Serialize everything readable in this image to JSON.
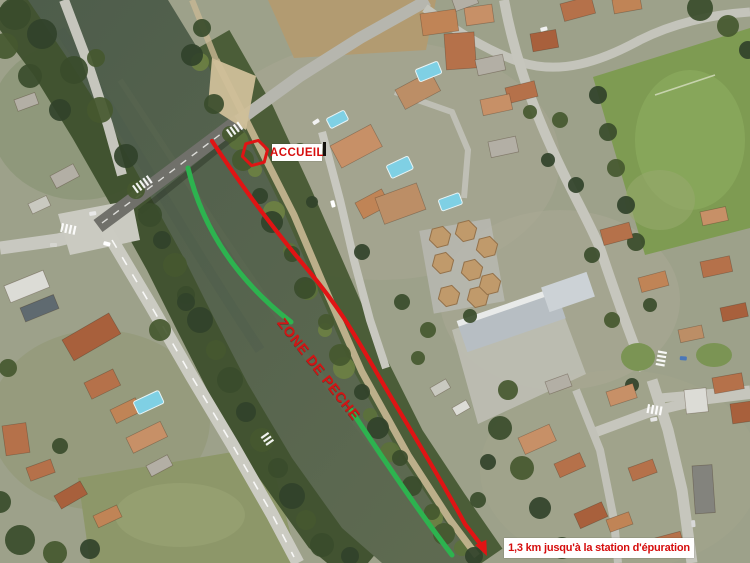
{
  "annotations": {
    "accueil": {
      "label": "ACCUEIL",
      "marker_shape": "hexagon"
    },
    "zone_de_peche": {
      "label": "ZONE DE PECHE"
    },
    "distance": {
      "label": "1,3 km jusqu'à la station d'épuration"
    }
  },
  "colors": {
    "route_red": "#e01414",
    "zone_green": "#2db34f",
    "label_text_red": "#d60d0d",
    "zone_text_red": "#d31414",
    "label_bg": "#ffffff"
  }
}
